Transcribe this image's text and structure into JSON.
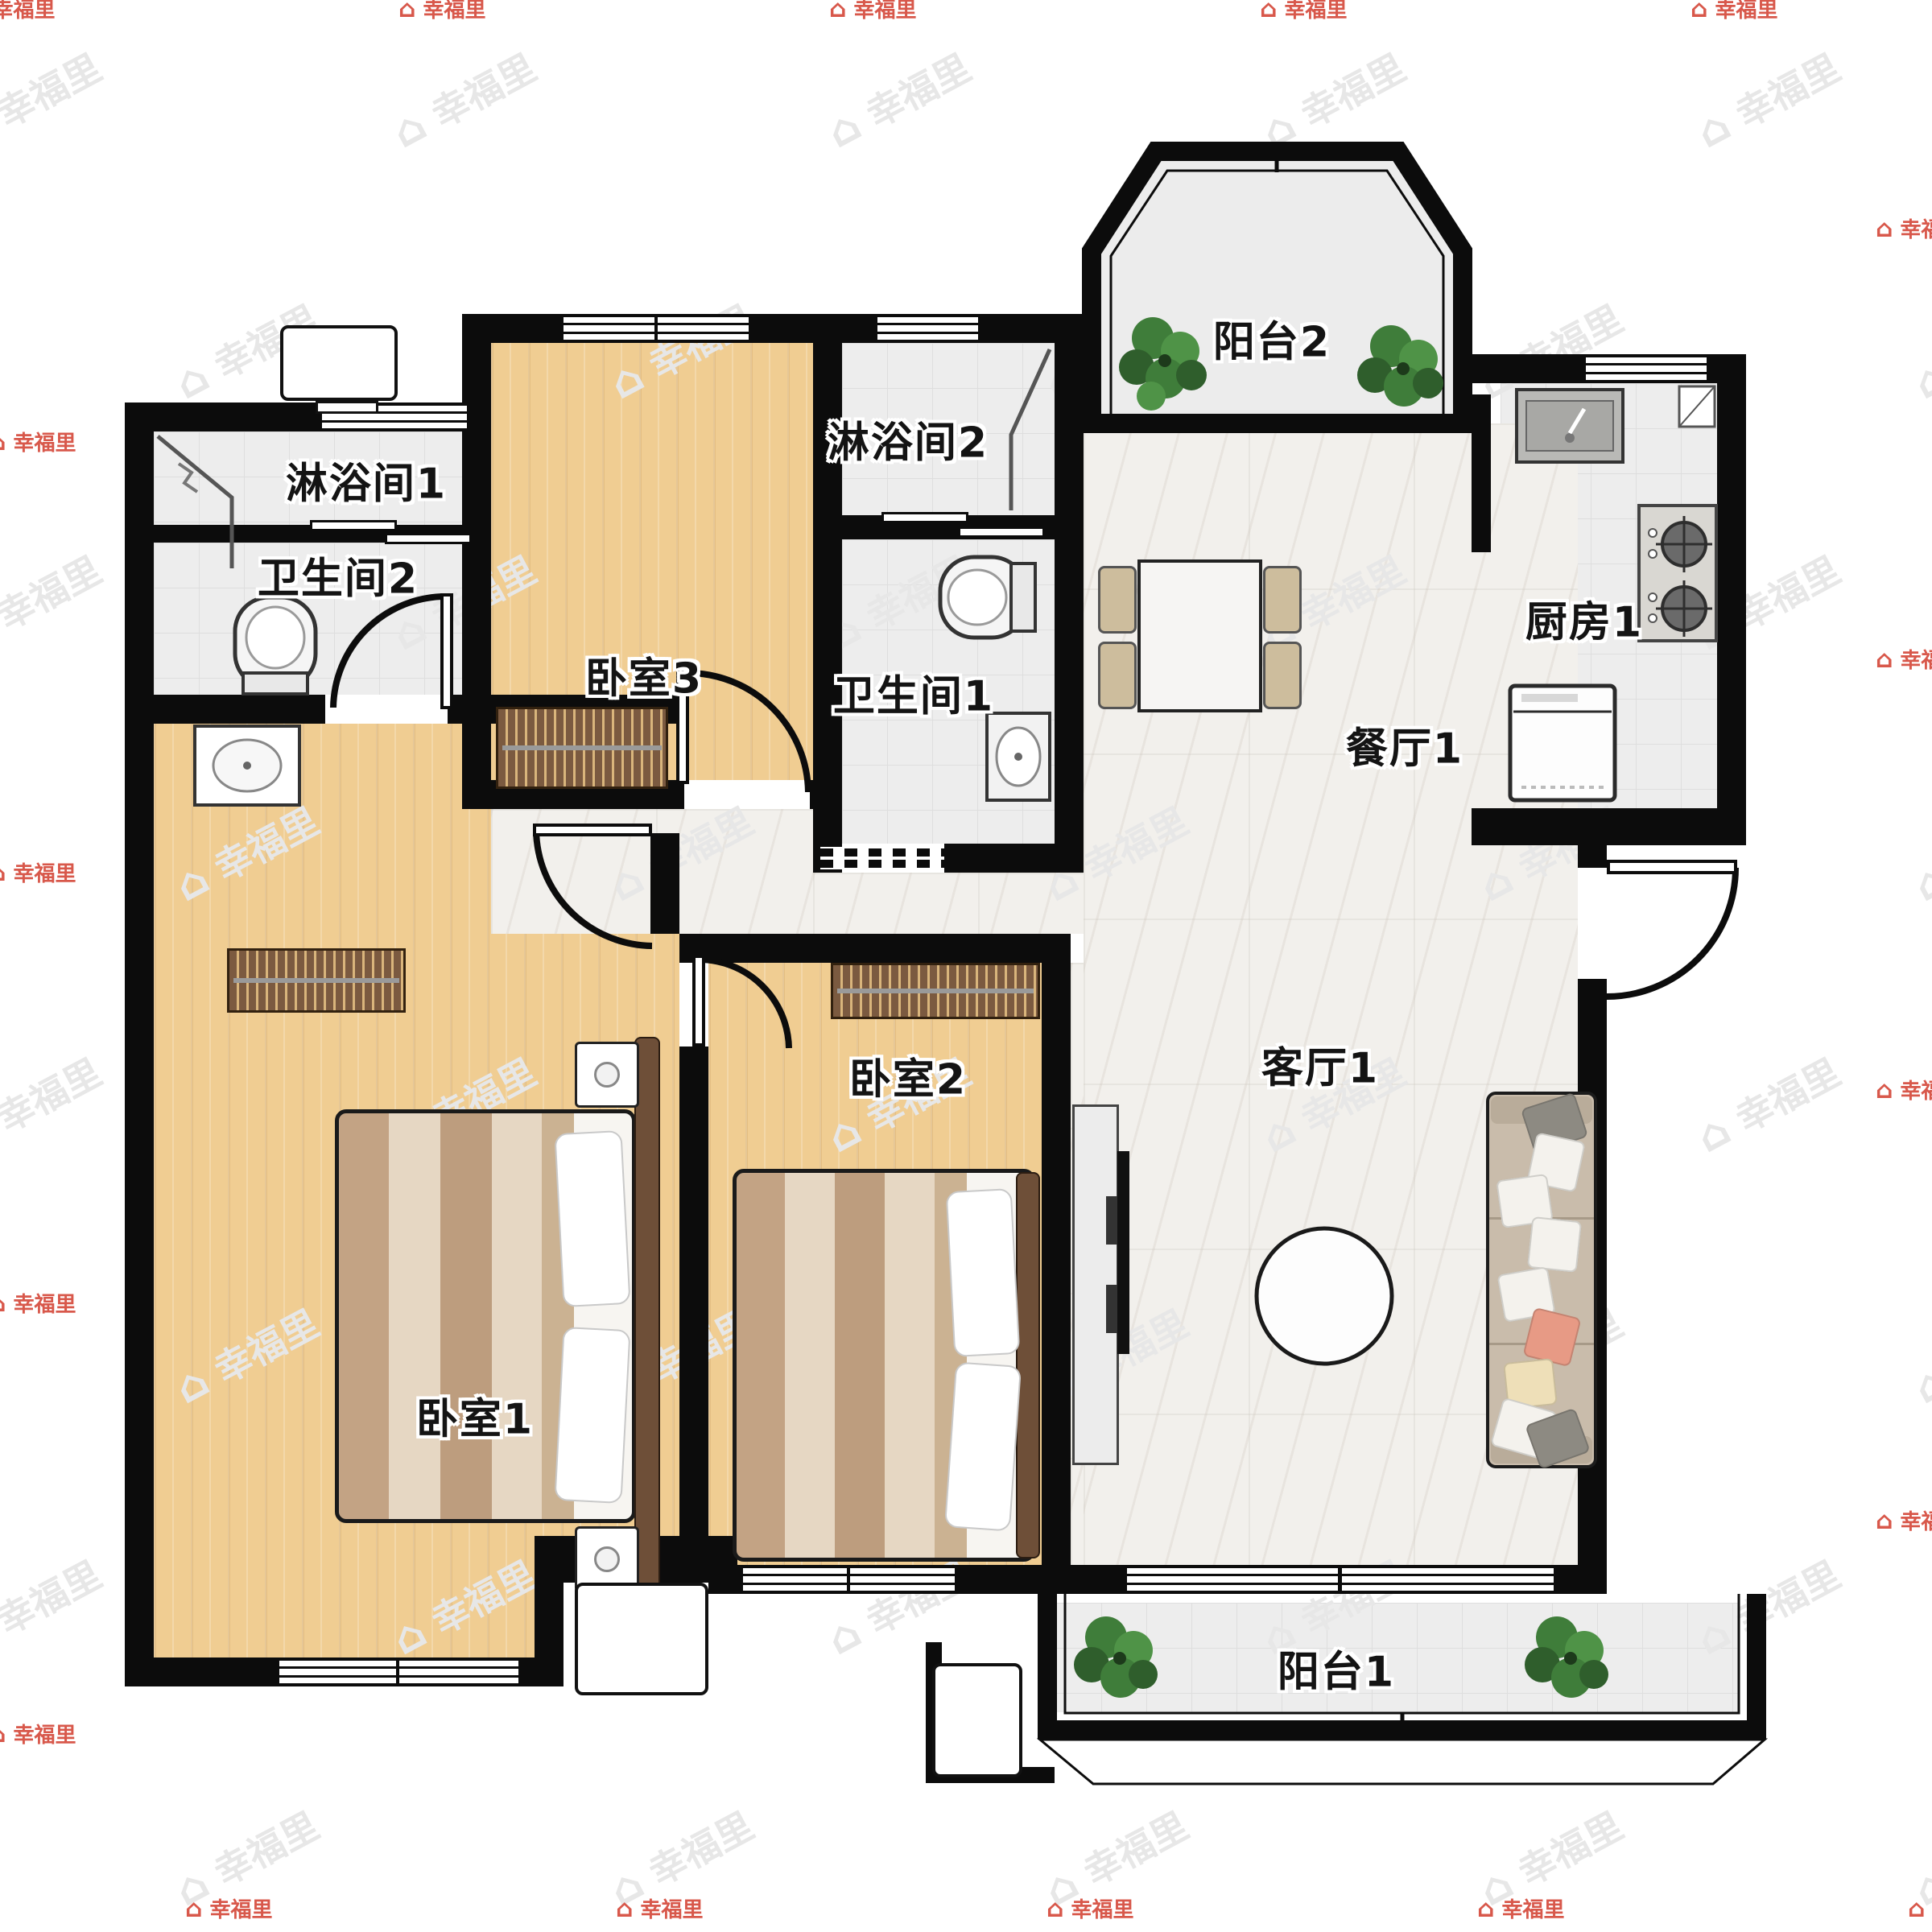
{
  "watermark": {
    "text": "幸福里"
  },
  "rooms": {
    "balcony_2": {
      "label": "阳台2"
    },
    "kitchen_1": {
      "label": "厨房1"
    },
    "dining_1": {
      "label": "餐厅1"
    },
    "living_1": {
      "label": "客厅1"
    },
    "balcony_1": {
      "label": "阳台1"
    },
    "bedroom_1": {
      "label": "卧室1"
    },
    "bedroom_2": {
      "label": "卧室2"
    },
    "bedroom_3": {
      "label": "卧室3"
    },
    "shower_1": {
      "label": "淋浴间1"
    },
    "shower_2": {
      "label": "淋浴间2"
    },
    "bath_1": {
      "label": "卫生间1"
    },
    "bath_2": {
      "label": "卫生间2"
    }
  },
  "colors": {
    "wall": "#0c0c0c",
    "wood_floor": "#f0cd92",
    "tile_floor": "#ededed",
    "marble_floor": "#f2f0ec",
    "plant_green": "#3f7d3a",
    "watermark_gray": "#e7e7e7",
    "watermark_red": "#d8584b"
  }
}
